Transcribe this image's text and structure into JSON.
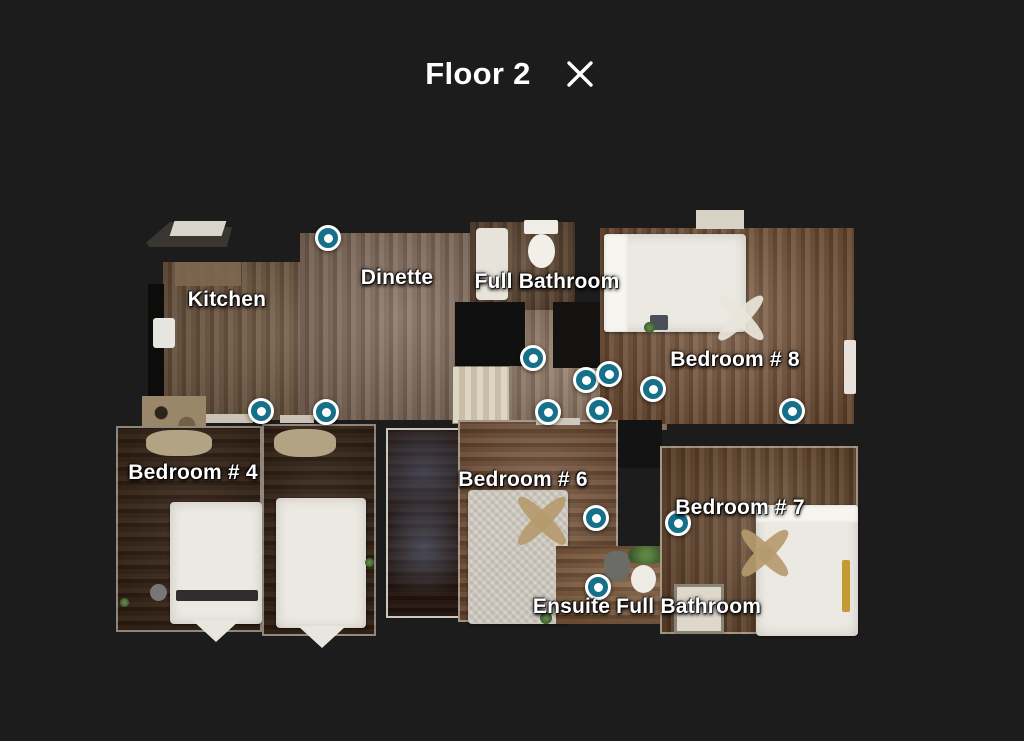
{
  "header": {
    "title": "Floor 2",
    "close_label": "Close"
  },
  "colors": {
    "background": "#1d1c1c",
    "marker": "#16708a",
    "marker_ring": "#ffffff",
    "label_text": "#ffffff"
  },
  "floorplan": {
    "floor_name": "Floor 2",
    "labels": [
      {
        "slug": "kitchen",
        "text": "Kitchen",
        "x": 227,
        "y": 300
      },
      {
        "slug": "dinette",
        "text": "Dinette",
        "x": 397,
        "y": 278
      },
      {
        "slug": "full-bathroom",
        "text": "Full Bathroom",
        "x": 547,
        "y": 282
      },
      {
        "slug": "bedroom-8",
        "text": "Bedroom # 8",
        "x": 735,
        "y": 360
      },
      {
        "slug": "bedroom-4",
        "text": "Bedroom # 4",
        "x": 193,
        "y": 473
      },
      {
        "slug": "bedroom-6",
        "text": "Bedroom # 6",
        "x": 523,
        "y": 480
      },
      {
        "slug": "bedroom-7",
        "text": "Bedroom # 7",
        "x": 740,
        "y": 508
      },
      {
        "slug": "ensuite-full-bathroom",
        "text": "Ensuite Full Bathroom",
        "x": 647,
        "y": 607
      }
    ],
    "markers": [
      {
        "x": 328,
        "y": 238
      },
      {
        "x": 261,
        "y": 411
      },
      {
        "x": 326,
        "y": 412
      },
      {
        "x": 533,
        "y": 358
      },
      {
        "x": 586,
        "y": 380
      },
      {
        "x": 609,
        "y": 374
      },
      {
        "x": 653,
        "y": 389
      },
      {
        "x": 548,
        "y": 412
      },
      {
        "x": 599,
        "y": 410
      },
      {
        "x": 792,
        "y": 411
      },
      {
        "x": 596,
        "y": 518
      },
      {
        "x": 678,
        "y": 523
      },
      {
        "x": 598,
        "y": 587
      }
    ]
  }
}
